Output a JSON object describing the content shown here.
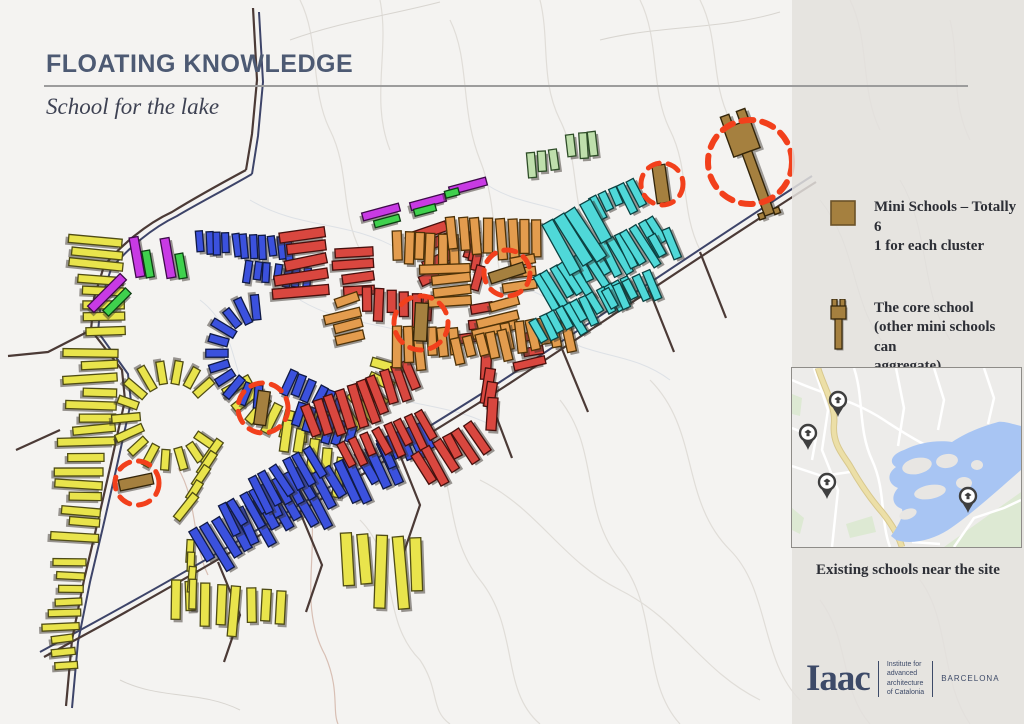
{
  "header": {
    "title": "FLOATING KNOWLEDGE",
    "subtitle": "School for the lake"
  },
  "legend": {
    "items": [
      {
        "icon": "mini-school-square",
        "lines": [
          "Mini Schools – Totally 6",
          "1 for each cluster"
        ]
      },
      {
        "icon": "core-school-key",
        "lines": [
          "The core school",
          "(other mini schools can",
          "aggregate)"
        ]
      }
    ]
  },
  "inset": {
    "caption": "Existing schools near the site",
    "colors": {
      "bg": "#edecea",
      "water": "#a8c5f3",
      "island": "#e8e6e3",
      "green": "#dde9d3",
      "white": "#ffffff",
      "tan": "#ecdfa7",
      "tan_edge": "#d8c88e",
      "pin": "#3f3f3f"
    },
    "water_path": "M229,58 C220,56 212,53 206,54 C196,57 178,62 160,74 C146,72 128,74 112,82 C100,86 96,94 104,99 C94,106 96,116 106,120 C98,129 101,138 110,141 C112,148 106,158 99,168 L104,172 C120,177 140,172 156,162 C180,146 208,120 229,102 Z",
    "islands": [
      [
        125,
        98,
        15,
        8,
        -12
      ],
      [
        155,
        93,
        11,
        7,
        -8
      ],
      [
        138,
        124,
        16,
        7,
        -10
      ],
      [
        172,
        115,
        8,
        6,
        0
      ],
      [
        116,
        146,
        9,
        5,
        -20
      ],
      [
        185,
        97,
        6,
        5,
        0
      ]
    ],
    "greens": [
      "M152,179 L229,124 L229,179 Z",
      "M0,26 L10,30 L8,48 L0,46 Z",
      "M54,156 L80,148 L84,164 L58,170 Z",
      "M0,140 L12,150 L8,166 L0,162 Z"
    ],
    "white_roads": [
      "M0,12 C30,26 62,32 92,52 C122,72 150,88 178,94",
      "M22,0 L36,42 L30,82 L46,122 L40,179",
      "M62,0 C72,30 66,62 80,92 C94,122 88,152 98,179",
      "M104,0 L112,40 L106,78",
      "M142,0 L152,32 L146,62",
      "M0,98 L30,108 L58,104",
      "M162,179 L182,150 L212,140 L229,132",
      "M192,0 L202,30 L196,56",
      "M0,60 L24,70 L20,92",
      "M120,174 L148,176"
    ],
    "tan_road": "M26,0 C32,20 44,38 42,56 C40,76 52,88 58,98 C66,112 76,128 90,144 C98,154 106,166 110,179",
    "pins": [
      {
        "x": 46,
        "y": 45
      },
      {
        "x": 16,
        "y": 78
      },
      {
        "x": 35,
        "y": 127
      },
      {
        "x": 176,
        "y": 141
      }
    ]
  },
  "logo": {
    "wordmark": "Iaac",
    "org_lines": [
      "Institute for",
      "advanced",
      "architecture",
      "of Catalonia"
    ],
    "city": "BARCELONA"
  },
  "map": {
    "shadow": "#3a342d",
    "roads": {
      "dark": "#4b3a36",
      "navy": "#3d4469",
      "dark_paths": [
        "M253,8 L257,80 L252,134 L246,170",
        "M246,170 C220,184 193,199 172,212 C146,224 120,246 104,266 L94,298 L91,330 L122,370 L125,400 L110,468 L97,525 L84,580 L72,640 L66,706",
        "M816,182 C724,240 614,315 504,387 C394,457 234,552 99,627 L44,657",
        "M700,252 L726,318",
        "M648,287 L674,352",
        "M560,344 L588,412",
        "M487,392 L512,458",
        "M398,450 L420,505 L404,552",
        "M300,512 L322,565 L306,612",
        "M218,562 L240,615 L224,662",
        "M91,330 L48,352 L8,356",
        "M60,430 L16,450"
      ],
      "navy_paths": [
        "M259,12 L263,82 L258,136 L252,174",
        "M252,174 C228,188 199,203 177,216 C152,228 127,249 111,269 L101,300 L98,332 L128,374 L131,402 L116,470 L103,527 L90,582 L78,642 L72,708",
        "M812,176 C720,235 610,310 500,382 C390,452 230,548 95,622 L40,652"
      ]
    },
    "clusters": [
      {
        "name": "yellow",
        "fill": "#e9e44c",
        "stroke": "#4f4c15",
        "groups": [
          {
            "type": "row",
            "x": 100,
            "y": 240,
            "dir": 88,
            "count": 8,
            "gap": 13,
            "rot": 92,
            "len": 44,
            "w": 8
          },
          {
            "type": "row",
            "x": 95,
            "y": 352,
            "dir": 92,
            "count": 8,
            "gap": 13,
            "rot": 88,
            "len": 46,
            "w": 8
          },
          {
            "type": "row",
            "x": 84,
            "y": 458,
            "dir": 94,
            "count": 7,
            "gap": 13,
            "rot": 91,
            "len": 40,
            "w": 8
          },
          {
            "type": "row",
            "x": 70,
            "y": 562,
            "dir": 96,
            "count": 6,
            "gap": 13,
            "rot": 90,
            "len": 32,
            "w": 7
          },
          {
            "type": "arc",
            "cx": 170,
            "cy": 416,
            "r": 44,
            "a0": 35,
            "a1": 320,
            "count": 15,
            "len": 25,
            "w": 8
          },
          {
            "type": "arc",
            "cx": 308,
            "cy": 345,
            "r": 82,
            "a0": 15,
            "a1": 150,
            "count": 13,
            "len": 30,
            "w": 9
          },
          {
            "type": "row",
            "x": 212,
            "y": 452,
            "dir": 115,
            "count": 5,
            "gap": 15,
            "rot": 35,
            "len": 28,
            "w": 8
          },
          {
            "type": "row",
            "x": 286,
            "y": 436,
            "dir": 35,
            "count": 5,
            "gap": 16,
            "rot": 8,
            "len": 32,
            "w": 9
          },
          {
            "type": "row",
            "x": 176,
            "y": 600,
            "dir": 6,
            "count": 8,
            "gap": 15,
            "rot": 1,
            "len": 40,
            "w": 9
          },
          {
            "type": "row",
            "x": 348,
            "y": 562,
            "dir": 4,
            "count": 5,
            "gap": 17,
            "rot": -2,
            "len": 58,
            "w": 11
          },
          {
            "type": "row",
            "x": 190,
            "y": 552,
            "dir": 86,
            "count": 4,
            "gap": 13,
            "rot": 4,
            "len": 24,
            "w": 7
          },
          {
            "type": "row",
            "x": 60,
            "y": 640,
            "dir": 80,
            "count": 3,
            "gap": 13,
            "rot": 85,
            "len": 26,
            "w": 7
          }
        ]
      },
      {
        "name": "blue",
        "fill": "#3b51dd",
        "stroke": "#101a45",
        "groups": [
          {
            "type": "row",
            "x": 200,
            "y": 242,
            "dir": 4,
            "count": 11,
            "gap": 9,
            "rot": -4,
            "len": 22,
            "w": 7
          },
          {
            "type": "row",
            "x": 247,
            "y": 270,
            "dir": 7,
            "count": 7,
            "gap": 10,
            "rot": 6,
            "len": 19,
            "w": 7
          },
          {
            "type": "arc",
            "cx": 262,
            "cy": 352,
            "r": 45,
            "a0": 95,
            "a1": 262,
            "count": 11,
            "len": 24,
            "w": 8
          },
          {
            "type": "row",
            "x": 289,
            "y": 382,
            "dir": 28,
            "count": 6,
            "gap": 11,
            "rot": 24,
            "len": 25,
            "w": 8
          },
          {
            "type": "row",
            "x": 299,
            "y": 414,
            "dir": 24,
            "count": 6,
            "gap": 11,
            "rot": 18,
            "len": 23,
            "w": 8
          },
          {
            "type": "row",
            "x": 205,
            "y": 548,
            "dir": -25,
            "count": 18,
            "gap": 12,
            "rot": -28,
            "len": 44,
            "w": 9
          },
          {
            "type": "row",
            "x": 228,
            "y": 518,
            "dir": -26,
            "count": 8,
            "gap": 12,
            "rot": -28,
            "len": 30,
            "w": 8
          },
          {
            "type": "row",
            "x": 258,
            "y": 492,
            "dir": -28,
            "count": 6,
            "gap": 13,
            "rot": -30,
            "len": 32,
            "w": 8
          },
          {
            "type": "row",
            "x": 385,
            "y": 452,
            "dir": -22,
            "count": 5,
            "gap": 11,
            "rot": -26,
            "len": 28,
            "w": 8
          }
        ]
      },
      {
        "name": "red",
        "fill": "#d9473f",
        "stroke": "#46100d",
        "groups": [
          {
            "type": "row",
            "x": 302,
            "y": 235,
            "dir": 86,
            "count": 5,
            "gap": 14,
            "rot": 82,
            "len": 46,
            "w": 10
          },
          {
            "type": "row",
            "x": 355,
            "y": 252,
            "dir": 88,
            "count": 4,
            "gap": 13,
            "rot": 86,
            "len": 36,
            "w": 9
          },
          {
            "type": "row",
            "x": 368,
            "y": 302,
            "dir": 8,
            "count": 6,
            "gap": 12,
            "rot": 2,
            "len": 30,
            "w": 9
          },
          {
            "type": "row",
            "x": 430,
            "y": 230,
            "dir": 78,
            "count": 4,
            "gap": 15,
            "rot": 68,
            "len": 34,
            "w": 10
          },
          {
            "type": "row",
            "x": 472,
            "y": 238,
            "dir": 82,
            "count": 4,
            "gap": 13,
            "rot": 12,
            "len": 25,
            "w": 8
          },
          {
            "type": "row",
            "x": 478,
            "y": 310,
            "dir": 86,
            "count": 3,
            "gap": 13,
            "rot": 84,
            "len": 30,
            "w": 9
          },
          {
            "type": "row",
            "x": 486,
            "y": 372,
            "dir": 82,
            "count": 4,
            "gap": 14,
            "rot": 6,
            "len": 34,
            "w": 10
          },
          {
            "type": "row",
            "x": 312,
            "y": 422,
            "dir": -24,
            "count": 10,
            "gap": 12,
            "rot": -20,
            "len": 36,
            "w": 9
          },
          {
            "type": "row",
            "x": 348,
            "y": 456,
            "dir": -22,
            "count": 8,
            "gap": 12,
            "rot": -26,
            "len": 30,
            "w": 8
          },
          {
            "type": "row",
            "x": 424,
            "y": 468,
            "dir": -30,
            "count": 6,
            "gap": 12,
            "rot": -32,
            "len": 34,
            "w": 9
          },
          {
            "type": "row",
            "x": 528,
            "y": 338,
            "dir": 80,
            "count": 3,
            "gap": 13,
            "rot": 80,
            "len": 26,
            "w": 8
          }
        ]
      },
      {
        "name": "orange",
        "fill": "#e39c4e",
        "stroke": "#4e3208",
        "groups": [
          {
            "type": "row",
            "x": 398,
            "y": 248,
            "dir": 4,
            "count": 6,
            "gap": 11,
            "rot": 0,
            "len": 34,
            "w": 9
          },
          {
            "type": "row",
            "x": 453,
            "y": 237,
            "dir": 2,
            "count": 8,
            "gap": 12,
            "rot": -3,
            "len": 40,
            "w": 9
          },
          {
            "type": "row",
            "x": 448,
            "y": 268,
            "dir": 88,
            "count": 4,
            "gap": 11,
            "rot": 86,
            "len": 44,
            "w": 9
          },
          {
            "type": "row",
            "x": 500,
            "y": 306,
            "dir": 92,
            "count": 3,
            "gap": 12,
            "rot": 78,
            "len": 38,
            "w": 9
          },
          {
            "type": "row",
            "x": 508,
            "y": 338,
            "dir": -8,
            "count": 6,
            "gap": 12,
            "rot": -10,
            "len": 30,
            "w": 9
          },
          {
            "type": "row",
            "x": 396,
            "y": 344,
            "dir": 2,
            "count": 6,
            "gap": 12,
            "rot": -2,
            "len": 36,
            "w": 9
          },
          {
            "type": "row",
            "x": 344,
            "y": 302,
            "dir": 82,
            "count": 4,
            "gap": 12,
            "rot": 74,
            "len": 30,
            "w": 9
          },
          {
            "type": "row",
            "x": 458,
            "y": 352,
            "dir": -10,
            "count": 5,
            "gap": 12,
            "rot": -12,
            "len": 28,
            "w": 9
          },
          {
            "type": "row",
            "x": 520,
            "y": 262,
            "dir": 86,
            "count": 3,
            "gap": 12,
            "rot": 82,
            "len": 30,
            "w": 9
          }
        ]
      },
      {
        "name": "cyan",
        "fill": "#4fd8d8",
        "stroke": "#0b4242",
        "groups": [
          {
            "type": "row",
            "x": 546,
            "y": 292,
            "dir": -27,
            "count": 15,
            "gap": 9,
            "rot": -30,
            "len": 38,
            "w": 8
          },
          {
            "type": "row",
            "x": 540,
            "y": 332,
            "dir": -25,
            "count": 12,
            "gap": 9,
            "rot": -28,
            "len": 28,
            "w": 8
          },
          {
            "type": "row",
            "x": 598,
            "y": 208,
            "dir": -24,
            "count": 5,
            "gap": 10,
            "rot": -27,
            "len": 25,
            "w": 8
          },
          {
            "type": "row",
            "x": 560,
            "y": 246,
            "dir": -28,
            "count": 4,
            "gap": 14,
            "rot": -30,
            "len": 54,
            "w": 12
          },
          {
            "type": "row",
            "x": 612,
            "y": 300,
            "dir": -24,
            "count": 5,
            "gap": 11,
            "rot": -26,
            "len": 25,
            "w": 8
          },
          {
            "type": "row",
            "x": 660,
            "y": 248,
            "dir": -24,
            "count": 2,
            "gap": 12,
            "rot": -26,
            "len": 30,
            "w": 8
          }
        ]
      },
      {
        "name": "palegreen",
        "fill": "#bfdfac",
        "stroke": "#2e4d28",
        "groups": [
          {
            "type": "row",
            "x": 532,
            "y": 166,
            "dir": -8,
            "count": 3,
            "gap": 11,
            "rot": -4,
            "len": 27,
            "w": 8
          },
          {
            "type": "row",
            "x": 572,
            "y": 148,
            "dir": -8,
            "count": 3,
            "gap": 11,
            "rot": -4,
            "len": 27,
            "w": 8
          }
        ]
      },
      {
        "name": "magenta",
        "fill": "#c83ae4",
        "stroke": "#3e0b4a",
        "groups": [
          {
            "type": "bars",
            "items": [
              [
                107,
                293,
                45,
                46,
                9
              ],
              [
                137,
                257,
                -10,
                40,
                9
              ],
              [
                168,
                258,
                -10,
                40,
                9
              ],
              [
                381,
                212,
                75,
                38,
                8
              ],
              [
                428,
                202,
                75,
                36,
                8
              ],
              [
                468,
                186,
                75,
                38,
                8
              ]
            ]
          }
        ]
      },
      {
        "name": "green",
        "fill": "#3fd14d",
        "stroke": "#0d3f12",
        "groups": [
          {
            "type": "bars",
            "items": [
              [
                117,
                302,
                45,
                32,
                8
              ],
              [
                148,
                264,
                -10,
                27,
                8
              ],
              [
                181,
                266,
                -10,
                25,
                8
              ],
              [
                387,
                221,
                75,
                26,
                7
              ],
              [
                425,
                210,
                75,
                22,
                7
              ],
              [
                452,
                193,
                75,
                14,
                7
              ]
            ]
          }
        ]
      }
    ],
    "schools": {
      "fill": "#a5803f",
      "stroke": "#33250a",
      "minis": [
        [
          136,
          482,
          78,
          34,
          11
        ],
        [
          262,
          408,
          8,
          34,
          12
        ],
        [
          421,
          322,
          3,
          38,
          13
        ],
        [
          507,
          273,
          72,
          36,
          11
        ],
        [
          661,
          184,
          -8,
          38,
          13
        ]
      ],
      "core": {
        "x": 749,
        "y": 158,
        "rot": -20
      }
    },
    "circles": {
      "color": "#f2401c",
      "items": [
        [
          137,
          483,
          22
        ],
        [
          263,
          408,
          25
        ],
        [
          421,
          323,
          27
        ],
        [
          507,
          273,
          23
        ],
        [
          662,
          184,
          21
        ],
        [
          750,
          162,
          42
        ]
      ]
    }
  }
}
